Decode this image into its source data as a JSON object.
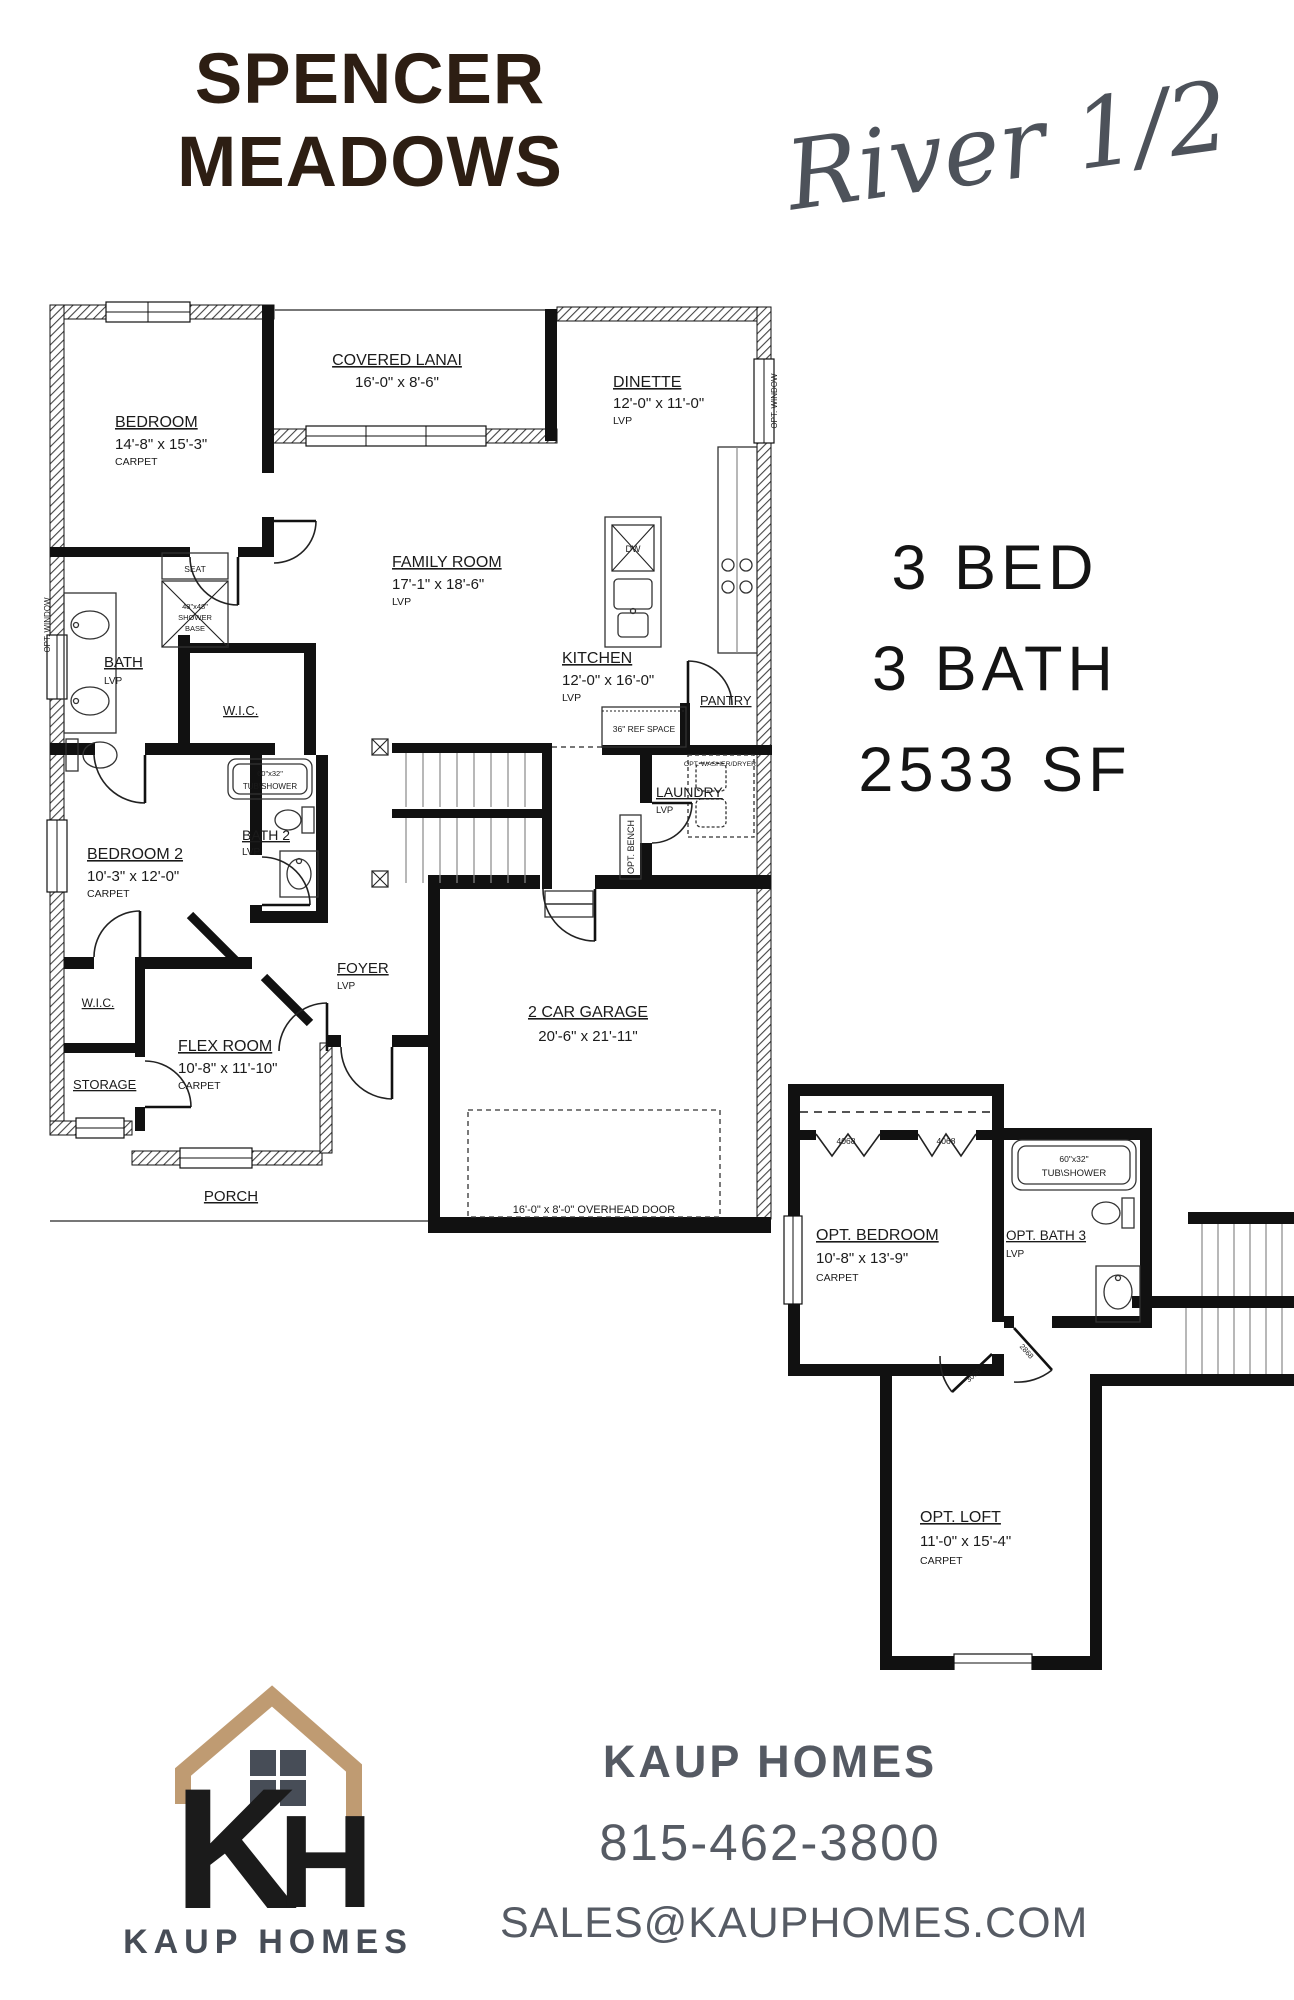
{
  "header": {
    "title_line1": "SPENCER",
    "title_line2": "MEADOWS",
    "plan_name": "River 1/2"
  },
  "summary": {
    "beds": "3 BED",
    "baths": "3 BATH",
    "sqft": "2533 SF"
  },
  "main_floor": {
    "bedroom": {
      "name": "BEDROOM",
      "dims": "14'-8\" x 15'-3\"",
      "floor": "CARPET"
    },
    "covered_lanai": {
      "name": "COVERED LANAI",
      "dims": "16'-0\" x 8'-6\""
    },
    "dinette": {
      "name": "DINETTE",
      "dims": "12'-0\" x 11'-0\"",
      "floor": "LVP"
    },
    "family_room": {
      "name": "FAMILY ROOM",
      "dims": "17'-1\" x 18'-6\"",
      "floor": "LVP"
    },
    "kitchen": {
      "name": "KITCHEN",
      "dims": "12'-0\" x 16'-0\"",
      "floor": "LVP"
    },
    "bath": {
      "name": "BATH",
      "floor": "LVP"
    },
    "wic_main": {
      "name": "W.I.C."
    },
    "bedroom2": {
      "name": "BEDROOM 2",
      "dims": "10'-3\" x 12'-0\"",
      "floor": "CARPET"
    },
    "bath2": {
      "name": "BATH 2",
      "floor": "LVP"
    },
    "laundry": {
      "name": "LAUNDRY",
      "floor": "LVP"
    },
    "foyer": {
      "name": "FOYER",
      "floor": "LVP"
    },
    "flex_room": {
      "name": "FLEX ROOM",
      "dims": "10'-8\" x 11'-10\"",
      "floor": "CARPET"
    },
    "wic_flex": {
      "name": "W.I.C."
    },
    "storage": {
      "name": "STORAGE"
    },
    "porch": {
      "name": "PORCH"
    },
    "garage": {
      "name": "2 CAR GARAGE",
      "dims": "20'-6\" x 21'-11\""
    },
    "pantry": {
      "name": "PANTRY"
    },
    "annotations": {
      "seat": "SEAT",
      "shower_size": "48\"x48\"",
      "shower_word1": "SHOWER",
      "shower_word2": "BASE",
      "tub_size": "60\"x32\"",
      "tub_word": "TUB\\SHOWER",
      "ref_space": "36\" REF SPACE",
      "opt_washer_dryer": "OPT. WASHER/DRYER",
      "opt_bench": "OPT. BENCH",
      "opt_window": "OPT. WINDOW",
      "overhead_door": "16'-0\" x 8'-0\" OVERHEAD DOOR",
      "dw": "DW"
    }
  },
  "second_floor": {
    "opt_bedroom": {
      "name": "OPT. BEDROOM",
      "dims": "10'-8\" x 13'-9\"",
      "floor": "CARPET"
    },
    "opt_bath3": {
      "name": "OPT. BATH 3",
      "floor": "LVP"
    },
    "opt_loft": {
      "name": "OPT. LOFT",
      "dims": "11'-0\" x 15'-4\"",
      "floor": "CARPET"
    },
    "annotations": {
      "closet1": "4068",
      "closet2": "4068",
      "tub_size": "60\"x32\"",
      "tub_word": "TUB\\SHOWER",
      "door1": "2868",
      "door2": "3068"
    }
  },
  "footer": {
    "logo_text": "KAUP HOMES",
    "company": "KAUP HOMES",
    "phone": "815-462-3800",
    "email": "SALES@KAUPHOMES.COM"
  },
  "colors": {
    "title_brown": "#2d1e13",
    "script_gray": "#4d525a",
    "plan_ink": "#111111",
    "footer_slate": "#555a63",
    "logo_tan": "#bf9b72",
    "logo_slate": "#474d57"
  }
}
